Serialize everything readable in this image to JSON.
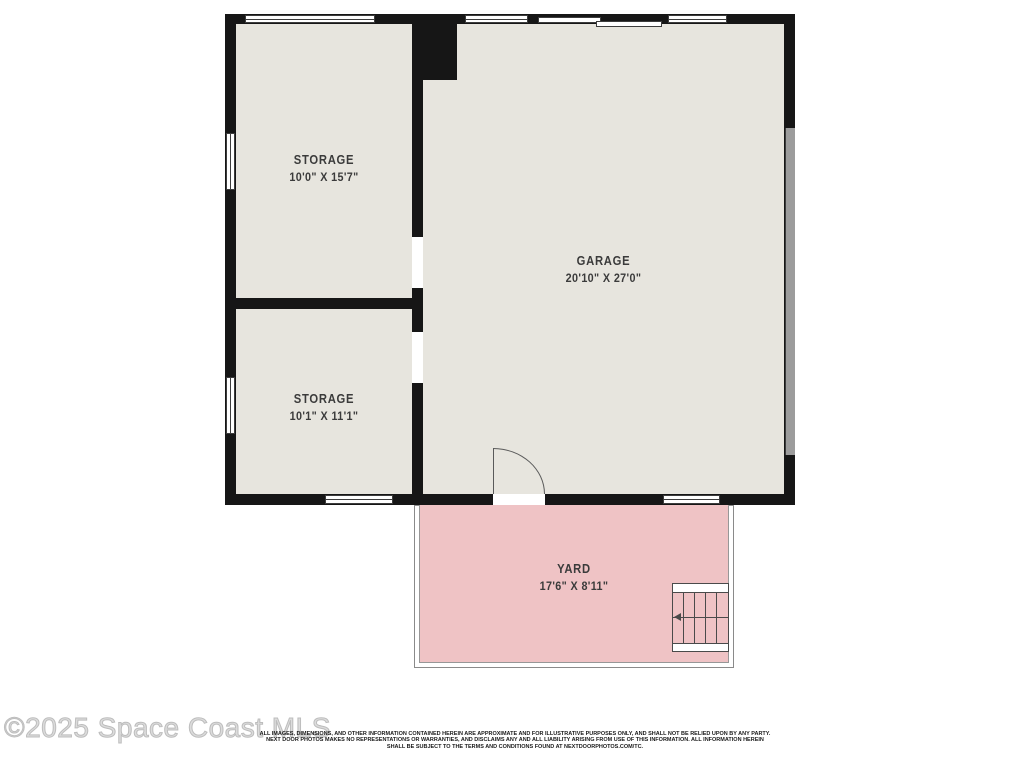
{
  "colors": {
    "wall": "#161616",
    "floor": "#e7e5de",
    "yard": "#efc3c5",
    "garage_door": "#9c9c9c"
  },
  "rooms": {
    "storage_upper": {
      "name": "STORAGE",
      "dims": "10'0\" X 15'7\""
    },
    "storage_lower": {
      "name": "STORAGE",
      "dims": "10'1\" X 11'1\""
    },
    "garage": {
      "name": "GARAGE",
      "dims": "20'10\" X 27'0\""
    },
    "yard": {
      "name": "YARD",
      "dims": "17'6\" X 8'11\""
    }
  },
  "footer": {
    "watermark": "©2025 Space Coast MLS",
    "disclaimer": {
      "line1": "ALL IMAGES, DIMENSIONS, AND OTHER INFORMATION CONTAINED HEREIN ARE APPROXIMATE AND FOR ILLUSTRATIVE PURPOSES ONLY, AND SHALL NOT BE RELIED UPON BY ANY PARTY.",
      "line2": "NEXT DOOR PHOTOS MAKES NO REPRESENTATIONS OR WARRANTIES, AND DISCLAIMS ANY AND ALL LIABILITY ARISING FROM USE OF THIS INFORMATION. ALL INFORMATION HEREIN",
      "line3": "SHALL BE SUBJECT TO THE TERMS AND CONDITIONS FOUND AT NEXTDOORPHOTOS.COM/TC."
    }
  }
}
